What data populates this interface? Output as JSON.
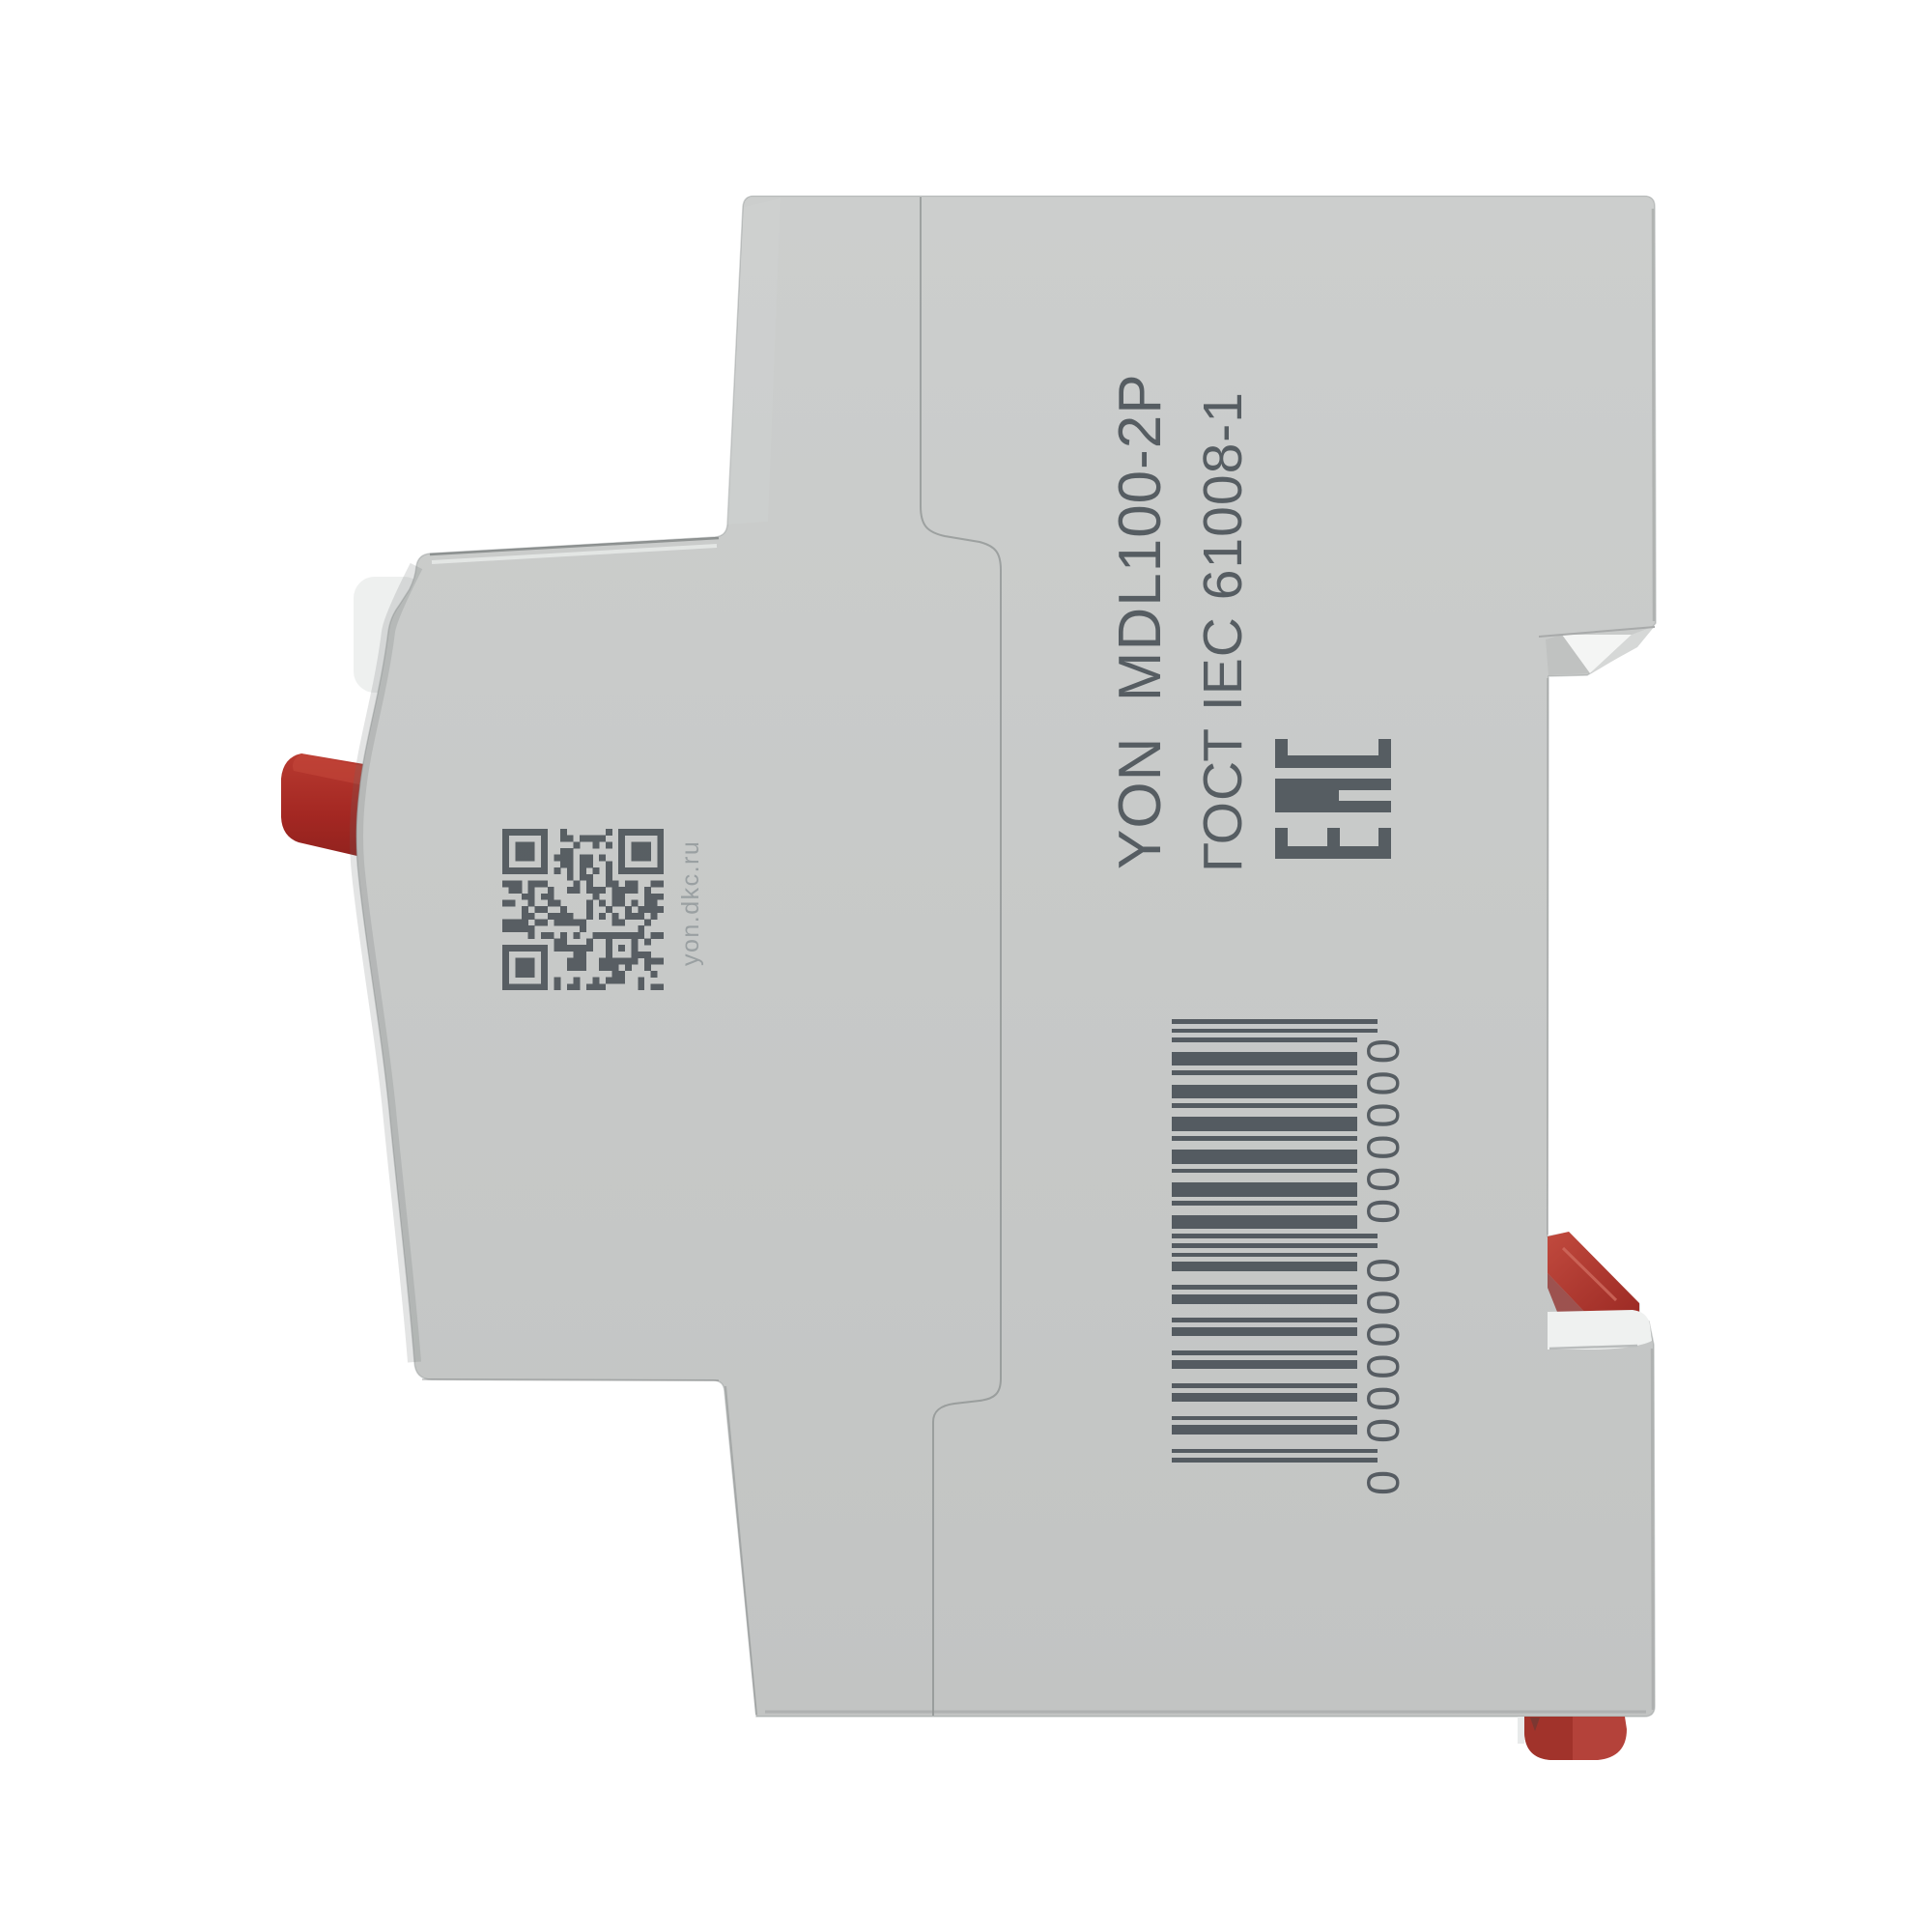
{
  "scene": {
    "background": "#ffffff",
    "description_colors": {
      "body_gray": "#c8cac9",
      "ink": "#4d545a",
      "accent_red": "#a92d27",
      "caption_gray": "#9aa0a2",
      "white_part": "#eff1f0"
    }
  },
  "device": {
    "side_markings": {
      "model_line": "YON  MDL100-2P",
      "standard_line": "ГОСТ IEC 61008-1",
      "eac_label": "EAC",
      "qr_caption": "yon.dkc.ru",
      "barcode": {
        "value": "0000000000000",
        "display_groups": [
          "0",
          "000000",
          "000000"
        ]
      }
    }
  }
}
